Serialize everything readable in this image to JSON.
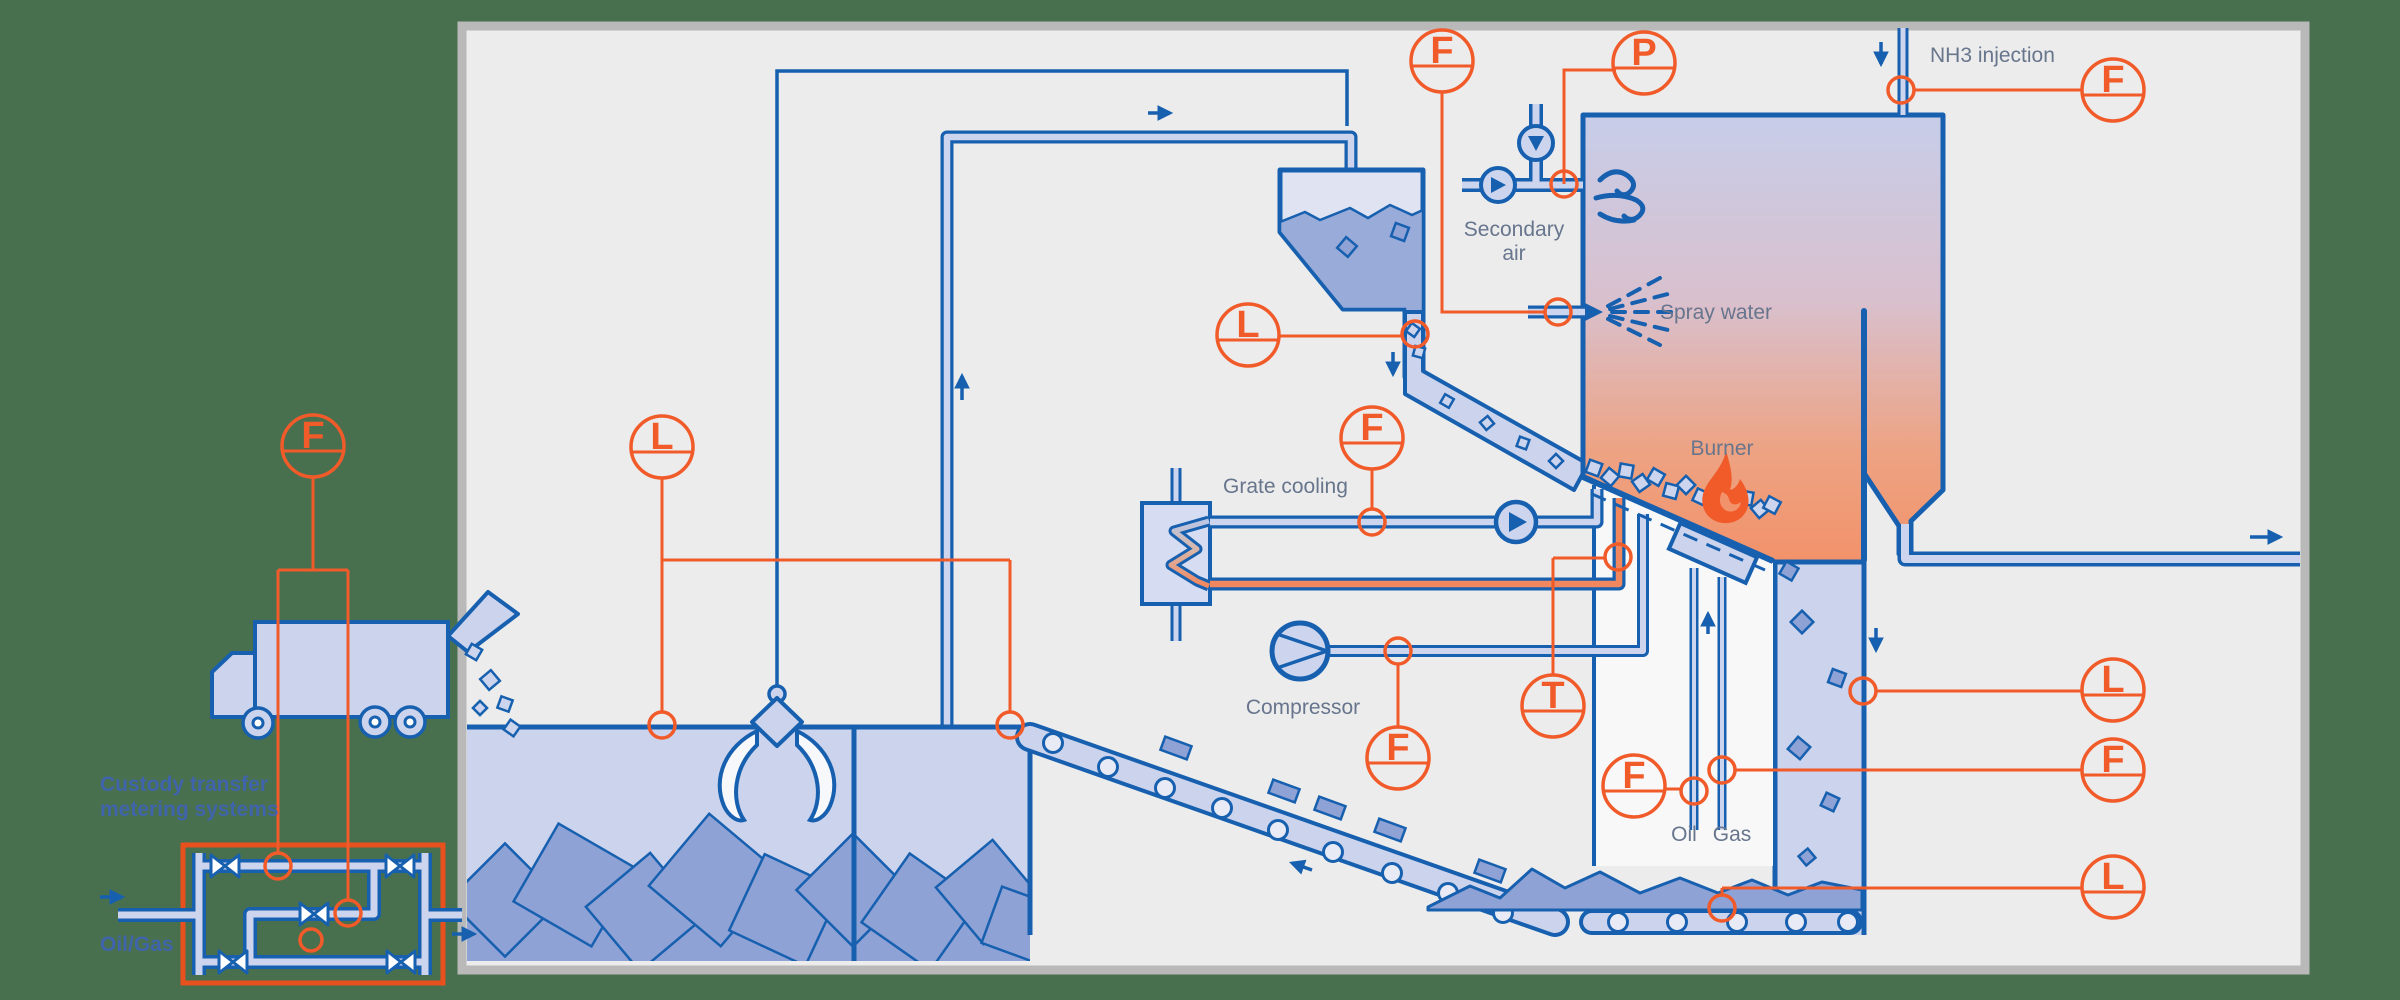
{
  "colors": {
    "accent_orange": "#f15a29",
    "line_blue": "#1760af",
    "pipe_fill": "#ccd5ed",
    "hot_fill": "#f0875f",
    "waste_fill": "#8ea2d6",
    "panel_bg": "#ececec",
    "panel_border": "#b9b9b9",
    "outside_bg": "#48704e",
    "label_gray": "#67758d",
    "label_blue": "#4064ab"
  },
  "labels": {
    "nh3_injection": "NH3 injection",
    "secondary_air_line1": "Secondary",
    "secondary_air_line2": "air",
    "spray_water": "Spray water",
    "burner": "Burner",
    "grate_cooling": "Grate cooling",
    "compressor": "Compressor",
    "oil": "Oil",
    "gas": "Gas",
    "custody_line1": "Custody transfer",
    "custody_line2": "metering systems",
    "oil_gas": "Oil/Gas"
  },
  "instruments": [
    {
      "id": "truck-flow",
      "letter": "F"
    },
    {
      "id": "bunker-level",
      "letter": "L"
    },
    {
      "id": "hopper-level",
      "letter": "L"
    },
    {
      "id": "spray-water-flow",
      "letter": "F"
    },
    {
      "id": "secondary-air-pressure",
      "letter": "P"
    },
    {
      "id": "nh3-flow",
      "letter": "F"
    },
    {
      "id": "grate-cooling-flow",
      "letter": "F"
    },
    {
      "id": "primary-air-flow",
      "letter": "F"
    },
    {
      "id": "grate-return-temperature",
      "letter": "T"
    },
    {
      "id": "oil-flow",
      "letter": "F"
    },
    {
      "id": "first-pass-level",
      "letter": "L"
    },
    {
      "id": "gas-flow",
      "letter": "F"
    },
    {
      "id": "ash-level",
      "letter": "L"
    }
  ]
}
